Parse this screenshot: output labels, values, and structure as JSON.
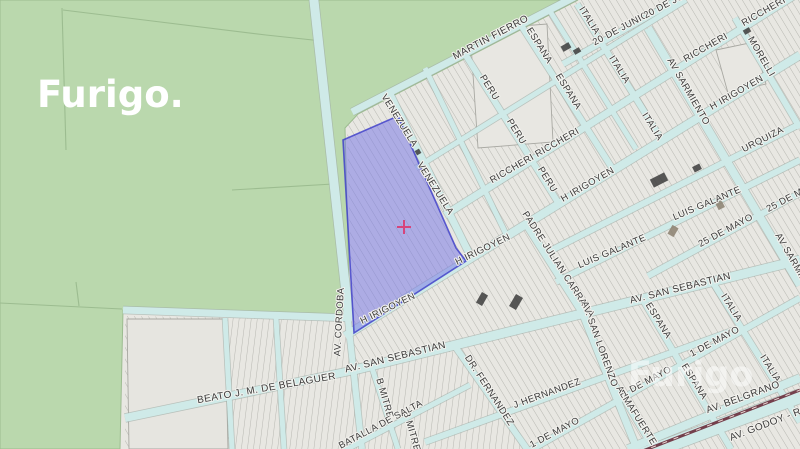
{
  "watermark": {
    "primary": "Furigo.",
    "secondary": "Furigo"
  },
  "map": {
    "marker": {
      "symbol": "+",
      "color": "#d6457c"
    },
    "highlight": {
      "fill": "#7b7be6",
      "border": "#3b3bc8"
    },
    "colors": {
      "rural_green": "#bad8ad",
      "street_fill": "#cfeae8",
      "street_casing": "#9fada8",
      "block_gray": "#e8e7e2",
      "parcel_line": "#b2b2ac",
      "railway": "#74404c",
      "label_text": "#3a3a3a",
      "watermark": "#ffffff"
    },
    "street_labels": [
      "MARTIN FIERRO",
      "ESPANA",
      "PERU",
      "ESPANA",
      "PERU",
      "RICCHERI RICCHERI",
      "PERU",
      "RICCHERI",
      "RICCHERI",
      "ITALIA",
      "ITALIA",
      "ITALIA",
      "20 DE JUNIO",
      "20 DE JUNIO",
      "AV SARMIENTO",
      "AV SARMIENTO",
      "MORELLI",
      "H IRIGOYEN",
      "H IRIGOYEN",
      "H IRIGOYEN",
      "H IRIGOYEN",
      "URQUIZA",
      "LUIS GALANTE",
      "LUIS GALANTE",
      "25 DE MAYO",
      "25 DE MAYO",
      "PADRE JULIAN CARRARA",
      "VENEZUELA",
      "VENEZUELA",
      "AV. CORDOBA",
      "AV. SAN SEBASTIAN",
      "AV. SAN SEBASTIAN",
      "BEATO J. M. DE BELAGUER",
      "B MITRE",
      "B MITRE",
      "BATALLA DE SALTA",
      "DR. FERNANDEZ",
      "J HERNANDEZ",
      "AV. SAN LORENZO",
      "ESPANA",
      "ESPANA",
      "ALMAFUERTE",
      "1 DE MAYO",
      "1 DE MAYO",
      "1 DE MAYO",
      "ITALIA",
      "ITALIA",
      "AV. BELGRANO",
      "AV. GODOY - RU"
    ]
  }
}
